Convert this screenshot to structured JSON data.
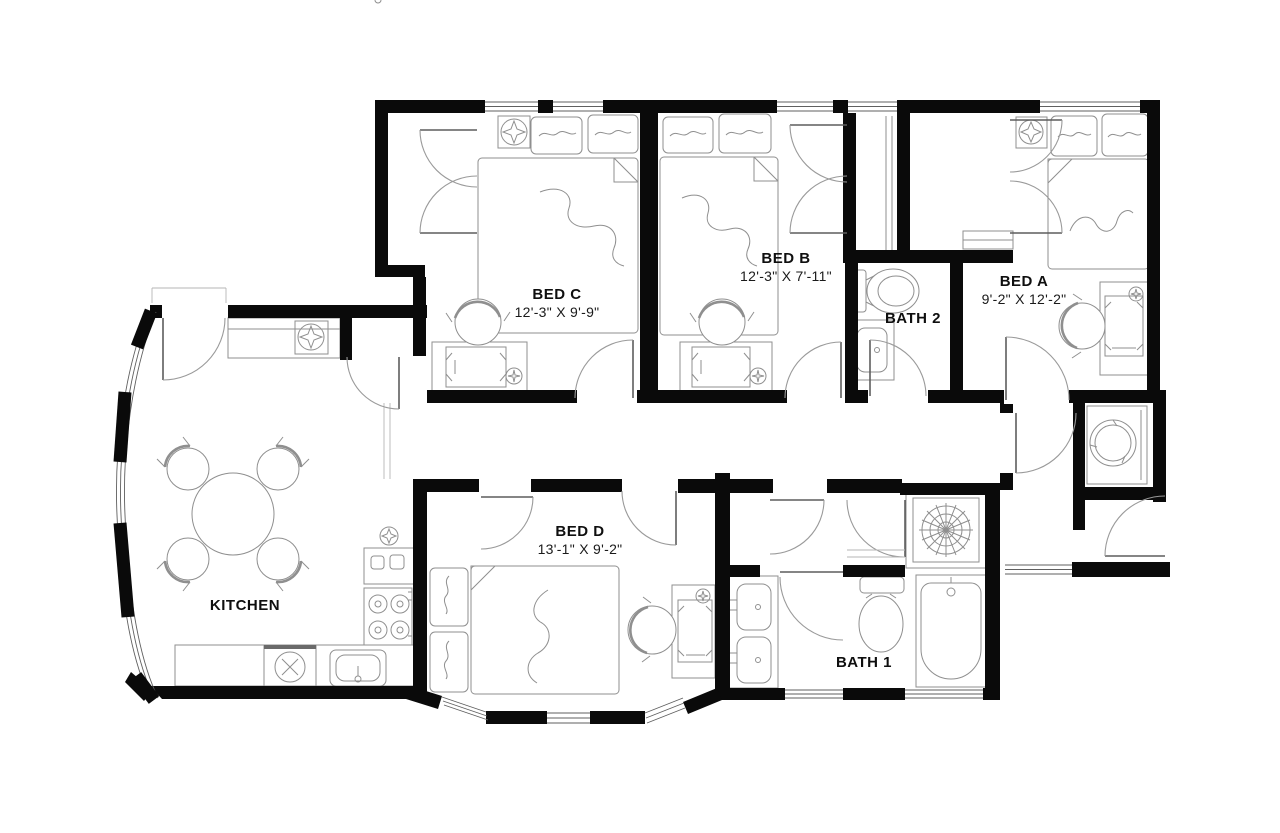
{
  "floor_plan": {
    "rooms": [
      {
        "id": "bed-c",
        "label": "BED C",
        "dimensions": "12'-3\" X 9'-9\""
      },
      {
        "id": "bed-b",
        "label": "BED B",
        "dimensions": "12'-3\" X 7'-11\""
      },
      {
        "id": "bed-a",
        "label": "BED A",
        "dimensions": "9'-2\" X 12'-2\""
      },
      {
        "id": "bed-d",
        "label": "BED D",
        "dimensions": "13'-1\" X 9'-2\""
      },
      {
        "id": "bath-2",
        "label": "BATH 2",
        "dimensions": ""
      },
      {
        "id": "bath-1",
        "label": "BATH 1",
        "dimensions": ""
      },
      {
        "id": "kitchen",
        "label": "KITCHEN",
        "dimensions": ""
      }
    ],
    "colors": {
      "walls": "#0a0a0a",
      "background": "#ffffff",
      "fixture_lines": "#8f8f8f",
      "text": "#0f0f0f"
    }
  }
}
